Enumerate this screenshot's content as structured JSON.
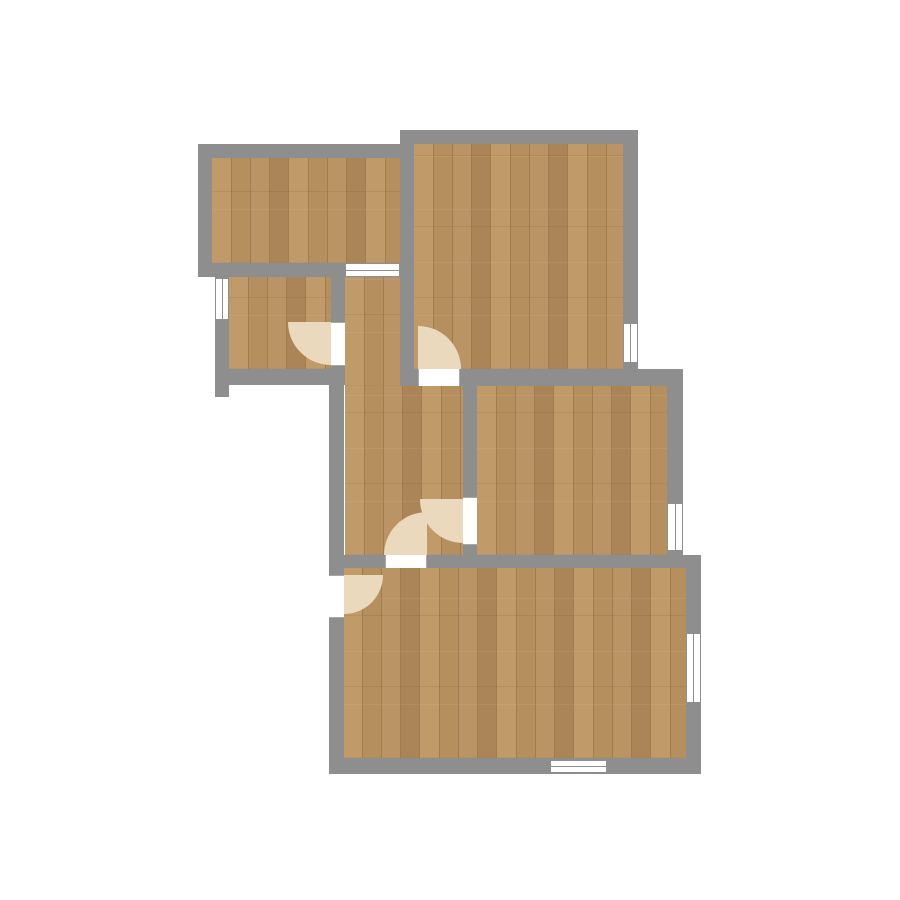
{
  "app": {
    "type": "floor-plan-viewer",
    "background": "#ffffff"
  },
  "colors": {
    "bg": "#ffffff",
    "wall": "#8e8e8e",
    "frame": "#8f8f8f",
    "jamb": "#a8a8a8",
    "opening": "#ffffff",
    "swing": "#ebd9bd",
    "floor_mid": "#b68f5f",
    "floor_light": "#c09a69",
    "floor_light2": "#bb9465",
    "floor_dark": "#ab8557",
    "floor_seam": "#a07c4e"
  },
  "plan": {
    "floors": [
      {
        "name": "room-top-left",
        "x": 212,
        "y": 158,
        "w": 188,
        "h": 105
      },
      {
        "name": "room-top-right",
        "x": 414,
        "y": 144,
        "w": 209,
        "h": 225
      },
      {
        "name": "room-small-left",
        "x": 229,
        "y": 277,
        "w": 102,
        "h": 92
      },
      {
        "name": "hall-upper",
        "x": 345,
        "y": 277,
        "w": 55,
        "h": 109
      },
      {
        "name": "hall-lower",
        "x": 345,
        "y": 386,
        "w": 118,
        "h": 169
      },
      {
        "name": "room-middle-right",
        "x": 477,
        "y": 386,
        "w": 190,
        "h": 169
      },
      {
        "name": "room-bottom",
        "x": 343,
        "y": 568,
        "w": 343,
        "h": 190
      }
    ],
    "walls": [
      {
        "name": "top-left-room-top",
        "x": 198,
        "y": 144,
        "w": 202,
        "h": 14
      },
      {
        "name": "top-right-room-top",
        "x": 400,
        "y": 130,
        "w": 238,
        "h": 14
      },
      {
        "name": "top-left-room-bottom",
        "x": 198,
        "y": 263,
        "w": 147,
        "h": 14
      },
      {
        "name": "middle-horizontal",
        "x": 400,
        "y": 369,
        "w": 283,
        "h": 17
      },
      {
        "name": "small-room-bottom",
        "x": 215,
        "y": 369,
        "w": 130,
        "h": 16
      },
      {
        "name": "lower-middle-horizontal",
        "x": 329,
        "y": 555,
        "w": 372,
        "h": 13
      },
      {
        "name": "bottom-exterior",
        "x": 329,
        "y": 758,
        "w": 372,
        "h": 16
      },
      {
        "name": "top-left-room-left",
        "x": 198,
        "y": 144,
        "w": 14,
        "h": 133
      },
      {
        "name": "divider-topleft-topright",
        "x": 400,
        "y": 130,
        "w": 14,
        "h": 256
      },
      {
        "name": "top-right-room-right",
        "x": 623,
        "y": 130,
        "w": 15,
        "h": 256
      },
      {
        "name": "small-room-left",
        "x": 215,
        "y": 263,
        "w": 14,
        "h": 134
      },
      {
        "name": "divider-small-hall",
        "x": 331,
        "y": 263,
        "w": 14,
        "h": 122
      },
      {
        "name": "left-exterior",
        "x": 329,
        "y": 369,
        "w": 15,
        "h": 405
      },
      {
        "name": "divider-hall-middleright",
        "x": 463,
        "y": 369,
        "w": 14,
        "h": 199
      },
      {
        "name": "middle-right-room-right",
        "x": 667,
        "y": 369,
        "w": 16,
        "h": 199
      },
      {
        "name": "bottom-room-right",
        "x": 686,
        "y": 555,
        "w": 15,
        "h": 219
      }
    ],
    "windows": [
      {
        "name": "hall-top",
        "x": 345,
        "y": 263,
        "w": 55,
        "h": 14,
        "orientation": "h"
      },
      {
        "name": "top-right-room-east",
        "x": 623,
        "y": 323,
        "w": 15,
        "h": 40,
        "orientation": "v"
      },
      {
        "name": "small-room-west",
        "x": 215,
        "y": 278,
        "w": 14,
        "h": 42,
        "orientation": "v"
      },
      {
        "name": "middle-right-room-east",
        "x": 667,
        "y": 503,
        "w": 16,
        "h": 48,
        "orientation": "v"
      },
      {
        "name": "bottom-room-south",
        "x": 550,
        "y": 760,
        "w": 57,
        "h": 13,
        "orientation": "h"
      },
      {
        "name": "bottom-room-east",
        "x": 686,
        "y": 633,
        "w": 15,
        "h": 70,
        "orientation": "v"
      }
    ],
    "doors": [
      {
        "name": "topright-to-hall",
        "x": 418,
        "y": 369,
        "w": 42,
        "h": 17,
        "orientation": "h"
      },
      {
        "name": "smallroom-to-hall",
        "x": 331,
        "y": 322,
        "w": 14,
        "h": 44,
        "orientation": "v"
      },
      {
        "name": "hall-to-bottomroom",
        "x": 385,
        "y": 555,
        "w": 42,
        "h": 13,
        "orientation": "h"
      },
      {
        "name": "hall-to-middleright",
        "x": 463,
        "y": 497,
        "w": 14,
        "h": 48,
        "orientation": "v"
      },
      {
        "name": "bottomroom-west",
        "x": 329,
        "y": 575,
        "w": 15,
        "h": 43,
        "orientation": "v"
      }
    ],
    "door_swings": [
      {
        "name": "topright-to-hall",
        "x": 418,
        "y": 326,
        "w": 43,
        "h": 43,
        "corner": "tr"
      },
      {
        "name": "smallroom-to-hall",
        "x": 288,
        "y": 322,
        "w": 43,
        "h": 43,
        "corner": "bl"
      },
      {
        "name": "hall-to-bottomroom",
        "x": 384,
        "y": 512,
        "w": 43,
        "h": 43,
        "corner": "tl"
      },
      {
        "name": "hall-to-middleright",
        "x": 420,
        "y": 499,
        "w": 43,
        "h": 44,
        "corner": "bl"
      },
      {
        "name": "bottomroom-west",
        "x": 344,
        "y": 575,
        "w": 39,
        "h": 39,
        "corner": "br"
      }
    ]
  }
}
